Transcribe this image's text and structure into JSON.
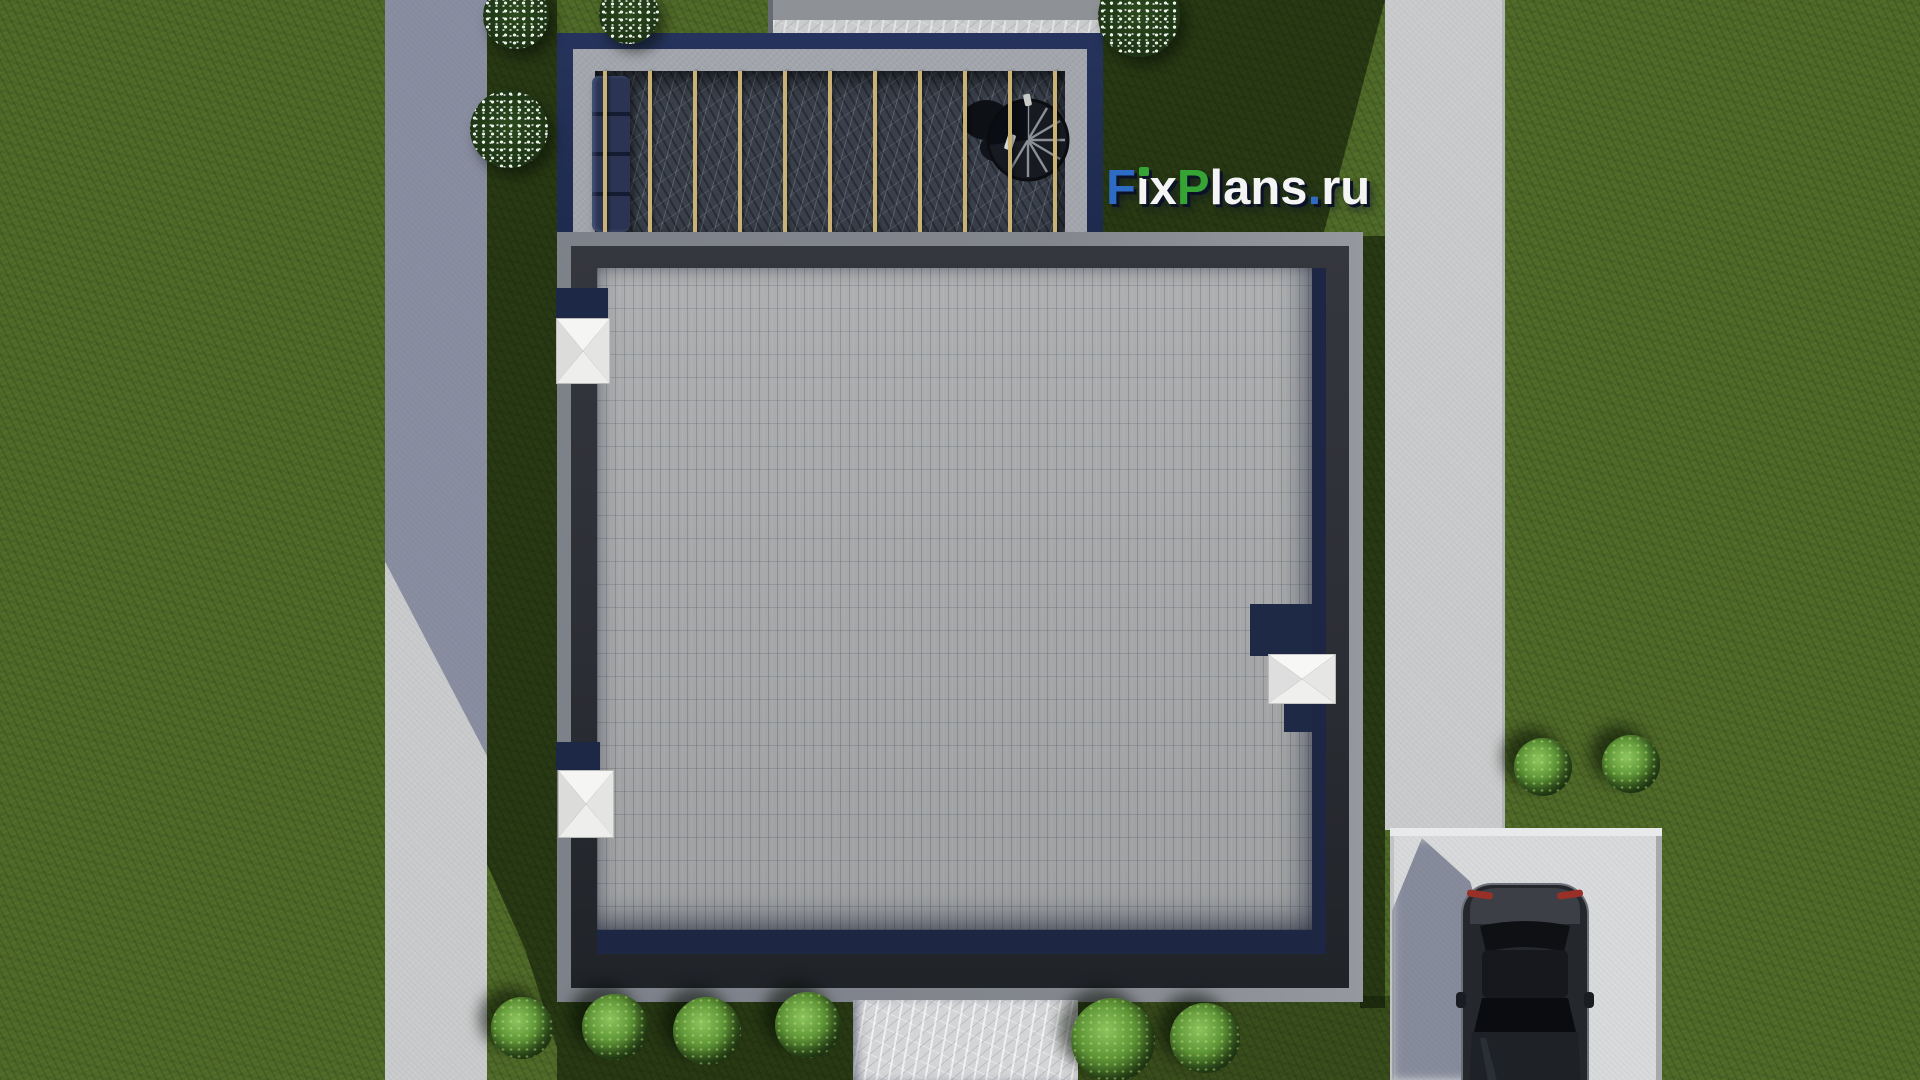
{
  "watermark": {
    "text": "FixPlans.ru",
    "segments": [
      {
        "text": "F",
        "color": "#2e6bc4"
      },
      {
        "text": "i",
        "color": "#f4f4f4"
      },
      {
        "text": "x",
        "color": "#f4f4f4"
      },
      {
        "text": "P",
        "color": "#35a435"
      },
      {
        "text": "lans",
        "color": "#f4f4f4"
      },
      {
        "text": ".",
        "color": "#2e6bc4"
      },
      {
        "text": "ru",
        "color": "#f4f4f4"
      }
    ]
  },
  "colors": {
    "grass": "#4e6827",
    "paver": "#a8aaac",
    "marble_dark": "#39404b",
    "marble_light": "#d4d5d7",
    "beam": "#c9b274",
    "concrete_path": "#c9cacb",
    "concrete_pad": "#d8d9da",
    "roof_trim": "#83868d",
    "parapet": "#2b2e34",
    "navy": "#1d2743",
    "pergola_frame": "#1e2a4e",
    "pergola_band": "#a2a5ac",
    "cap_white": "#f0f0ee",
    "car_body": "#24272c",
    "taillight": "#993028",
    "logo_blue": "#2e6bc4",
    "logo_green": "#35a435",
    "logo_white": "#f4f4f4",
    "logo_shadow": "#0b1226"
  },
  "pergola": {
    "beam_count": 11
  },
  "scenery": {
    "green_bushes": [
      {
        "x": 522,
        "y": 1028,
        "r": 31
      },
      {
        "x": 615,
        "y": 1027,
        "r": 33
      },
      {
        "x": 707,
        "y": 1031,
        "r": 34
      },
      {
        "x": 808,
        "y": 1025,
        "r": 33
      },
      {
        "x": 1113,
        "y": 1040,
        "r": 42
      },
      {
        "x": 1205,
        "y": 1038,
        "r": 35
      },
      {
        "x": 1543,
        "y": 767,
        "r": 29
      },
      {
        "x": 1631,
        "y": 764,
        "r": 29
      }
    ],
    "white_bushes": [
      {
        "x": 516,
        "y": 16,
        "r": 33
      },
      {
        "x": 629,
        "y": 14,
        "r": 30
      },
      {
        "x": 509,
        "y": 129,
        "r": 39
      },
      {
        "x": 1139,
        "y": 16,
        "r": 41
      }
    ]
  }
}
